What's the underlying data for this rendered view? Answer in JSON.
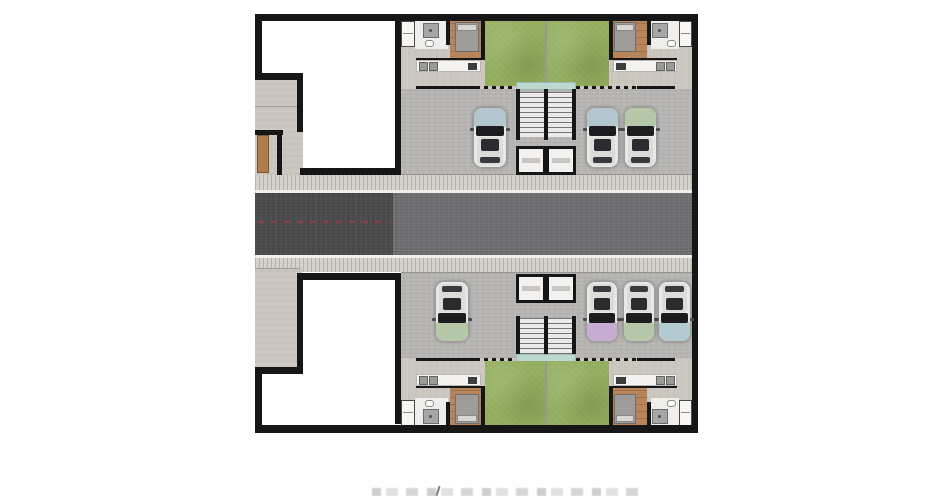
{
  "document": {
    "kind": "architectural-site-plan",
    "visible_text": [],
    "caption": {
      "visible": true,
      "legible": false,
      "position": "bottom-center-cropped"
    }
  },
  "palette": {
    "wall": "#161616",
    "lawn": "#93ad5e",
    "wood": "#b8855b",
    "asphalt_dark": "#4b4a4c",
    "asphalt_light": "#6f6e70",
    "sidewalk": "#d5d2cb",
    "garage": "#b6b5b3",
    "terrace": "#ccc8c1",
    "canopy": "#bcd8d1",
    "counter": "#f4f3f1",
    "bed": "#9e9c99",
    "door_wood": "#b07b4e",
    "centerline_red": "#9e3e3e"
  },
  "road": {
    "orientation": "horizontal",
    "surfaces": [
      "dark asphalt west segment",
      "light asphalt east segment"
    ],
    "centerline": "red dashed",
    "sidewalks": [
      "north",
      "south"
    ]
  },
  "north_building": {
    "units": [
      {
        "side": "left",
        "parking_spots_occupied": 1,
        "rooms": [
          "closet",
          "bathroom",
          "bedroom",
          "lawn",
          "kitchen-counter",
          "terrace",
          "garage"
        ]
      },
      {
        "side": "right",
        "parking_spots_occupied": 2,
        "rooms": [
          "closet",
          "bathroom",
          "bedroom",
          "lawn",
          "kitchen-counter",
          "terrace",
          "garage"
        ]
      }
    ],
    "core": [
      "stair-pair",
      "elevator-pair",
      "entrance-canopy"
    ]
  },
  "south_building": {
    "units": [
      {
        "side": "left",
        "parking_spots_occupied": 1,
        "rooms": [
          "closet",
          "bathroom",
          "bedroom",
          "lawn",
          "kitchen-counter",
          "terrace",
          "garage"
        ]
      },
      {
        "side": "right",
        "parking_spots_occupied": 3,
        "rooms": [
          "closet",
          "bathroom",
          "bedroom",
          "lawn",
          "kitchen-counter",
          "terrace",
          "garage"
        ]
      }
    ],
    "core": [
      "stair-pair",
      "elevator-pair",
      "entrance-canopy"
    ]
  },
  "west_wings": {
    "north": {
      "white_void_room": true,
      "gray_entry_path": true,
      "wood_gate_door": true
    },
    "south": {
      "white_void_room": true,
      "gray_entry_path": true,
      "wood_gate_door": false
    }
  },
  "cars": [
    {
      "id": "north-left-1",
      "x": 473,
      "y": 107,
      "w": 34,
      "h": 61,
      "dir": "up",
      "hood": "#b3c6ce"
    },
    {
      "id": "north-right-1",
      "x": 586,
      "y": 107,
      "w": 33,
      "h": 61,
      "dir": "up",
      "hood": "#b3c6ce"
    },
    {
      "id": "north-right-2",
      "x": 624,
      "y": 107,
      "w": 33,
      "h": 61,
      "dir": "up",
      "hood": "#b4c8a9"
    },
    {
      "id": "south-left-1",
      "x": 435,
      "y": 281,
      "w": 34,
      "h": 61,
      "dir": "down",
      "hood": "#b4c8a9"
    },
    {
      "id": "south-right-1",
      "x": 586,
      "y": 281,
      "w": 32,
      "h": 61,
      "dir": "down",
      "hood": "#c7add1"
    },
    {
      "id": "south-right-2",
      "x": 623,
      "y": 281,
      "w": 32,
      "h": 61,
      "dir": "down",
      "hood": "#b4c8a9"
    },
    {
      "id": "south-right-3",
      "x": 658,
      "y": 281,
      "w": 33,
      "h": 61,
      "dir": "down",
      "hood": "#b3cad1"
    }
  ]
}
